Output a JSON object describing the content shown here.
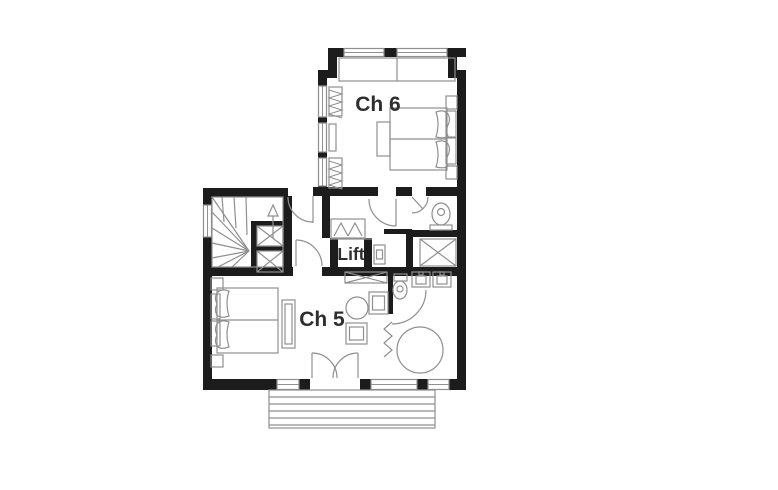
{
  "floorplan": {
    "labels": {
      "room_upper": "Ch 6",
      "room_lower": "Ch 5",
      "lift": "Lift"
    },
    "colors": {
      "wall": "#1c1c1c",
      "line": "#8f8f8f",
      "text": "#2e2e2e",
      "background": "#ffffff"
    },
    "symbols": [
      "staircase",
      "lift",
      "lift-shaft",
      "double-bed",
      "window-seat",
      "radiator",
      "wardrobe",
      "closet",
      "shower",
      "toilet",
      "washbasin",
      "round-bathtub",
      "towel-radiator",
      "table-and-chairs",
      "dresser",
      "french-door",
      "terrace-steps"
    ]
  }
}
